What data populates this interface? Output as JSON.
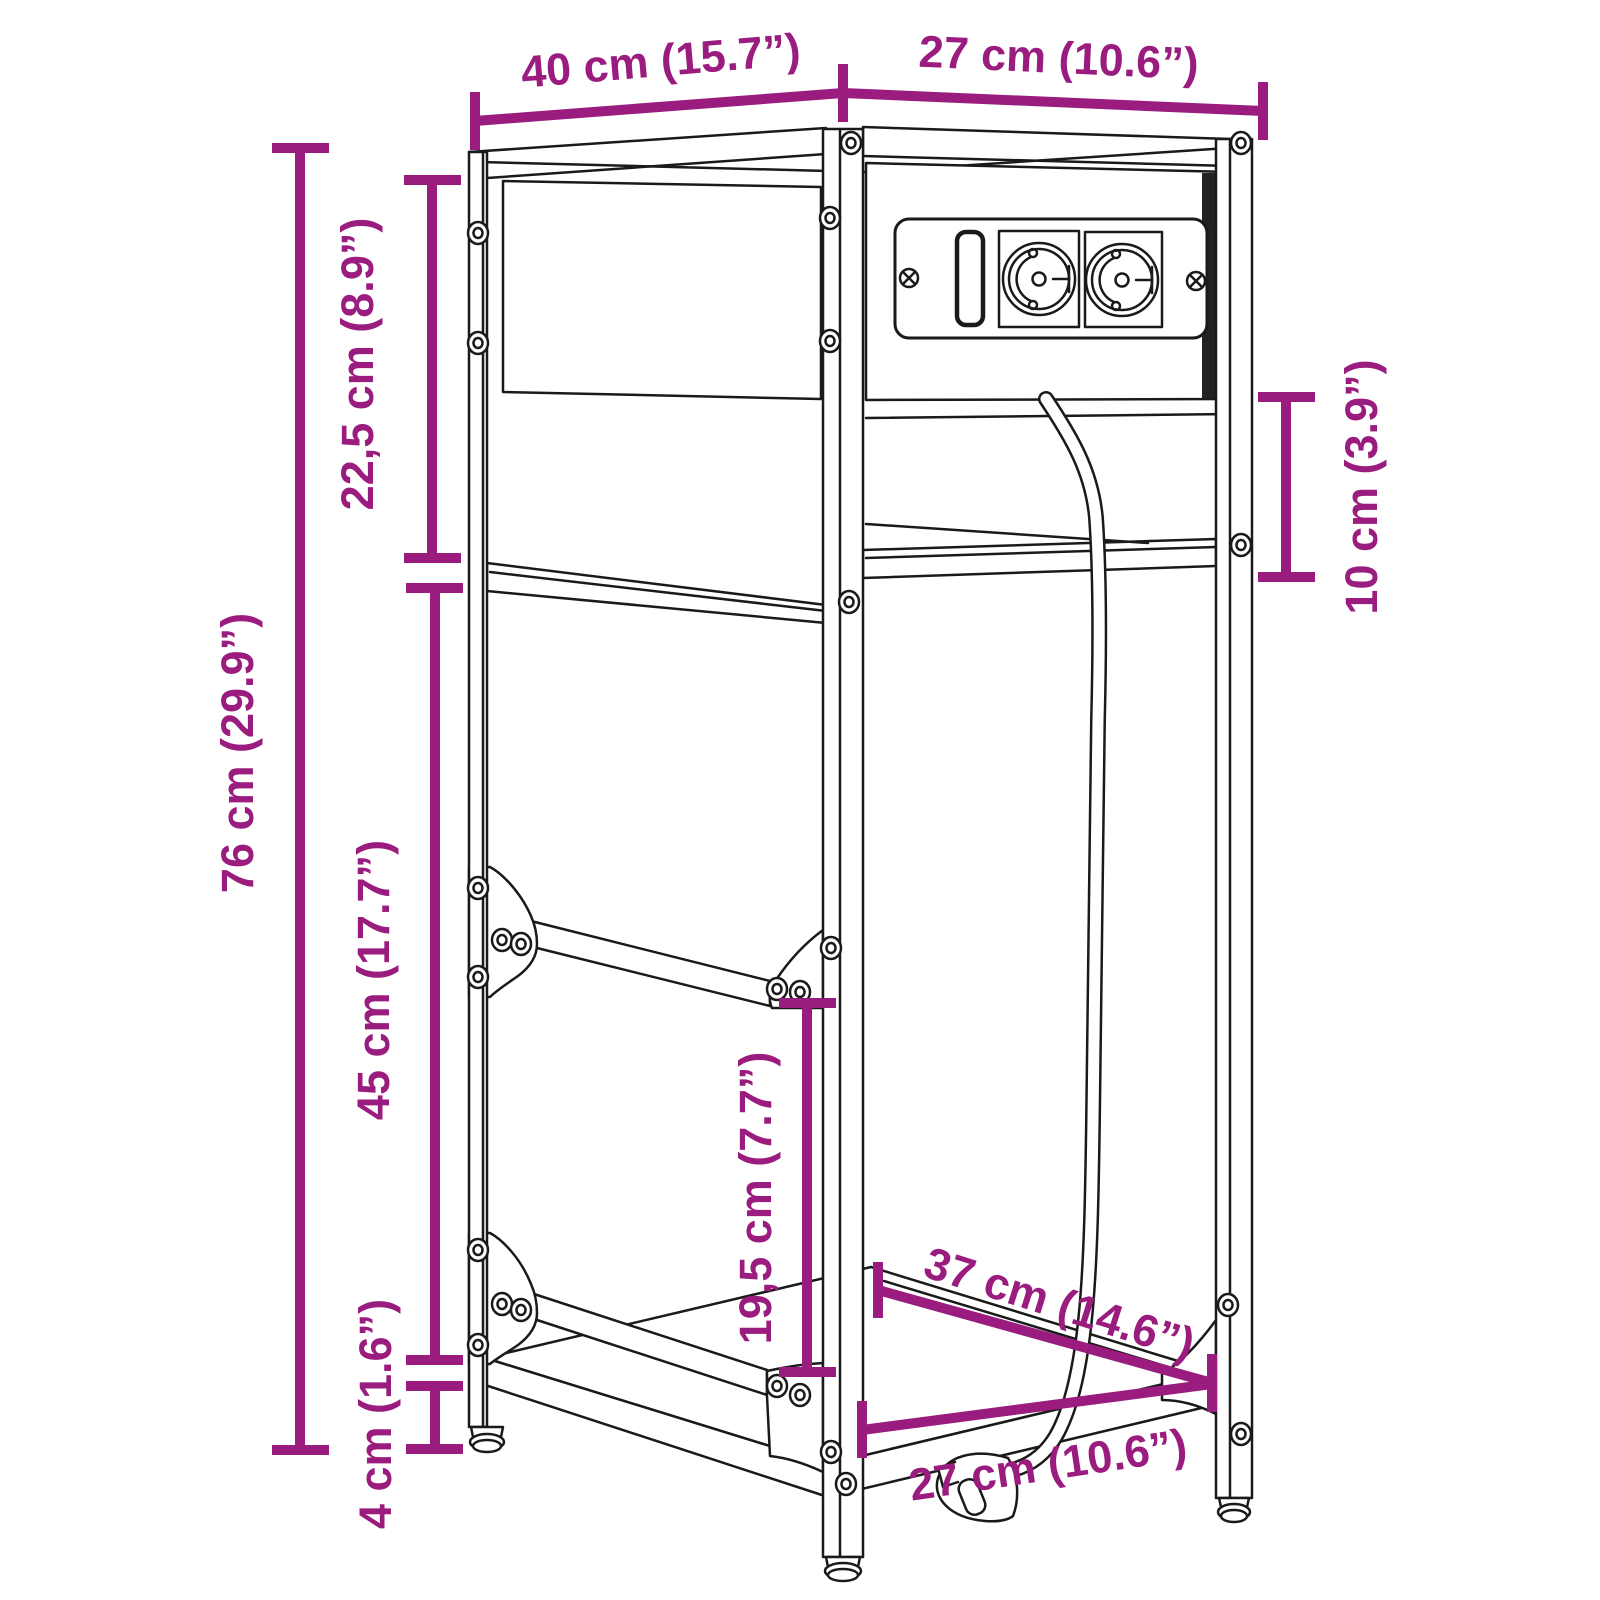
{
  "diagram": {
    "title": "Shelving unit dimension diagram",
    "product": "3-tier corner shelving unit with built-in power sockets and cable",
    "accent_color": "#9a1c7e",
    "line_color": "#1a1a1a",
    "dimensions": [
      {
        "id": "top-width",
        "label": "40 cm (15.7”)"
      },
      {
        "id": "top-depth",
        "label": "27 cm (10.6”)"
      },
      {
        "id": "upper-compartment-height",
        "label": "22,5 cm (8.9”)"
      },
      {
        "id": "total-height",
        "label": "76 cm (29.9”)"
      },
      {
        "id": "middle-compartment-height",
        "label": "45 cm (17.7”)"
      },
      {
        "id": "foot-height",
        "label": "4 cm (1.6”)"
      },
      {
        "id": "socket-panel-clearance",
        "label": "10 cm (3.9”)"
      },
      {
        "id": "bottom-shelf-clearance",
        "label": "19,5 cm (7.7”)"
      },
      {
        "id": "bottom-shelf-depth",
        "label": "37 cm (14.6”)"
      },
      {
        "id": "bottom-width",
        "label": "27 cm (10.6”)"
      }
    ],
    "icons": [
      {
        "name": "schuko-socket-icon",
        "count": 2
      },
      {
        "name": "usb-slot-icon",
        "count": 1
      },
      {
        "name": "power-plug-icon",
        "count": 1
      },
      {
        "name": "screw-icon",
        "count": "many"
      }
    ]
  }
}
